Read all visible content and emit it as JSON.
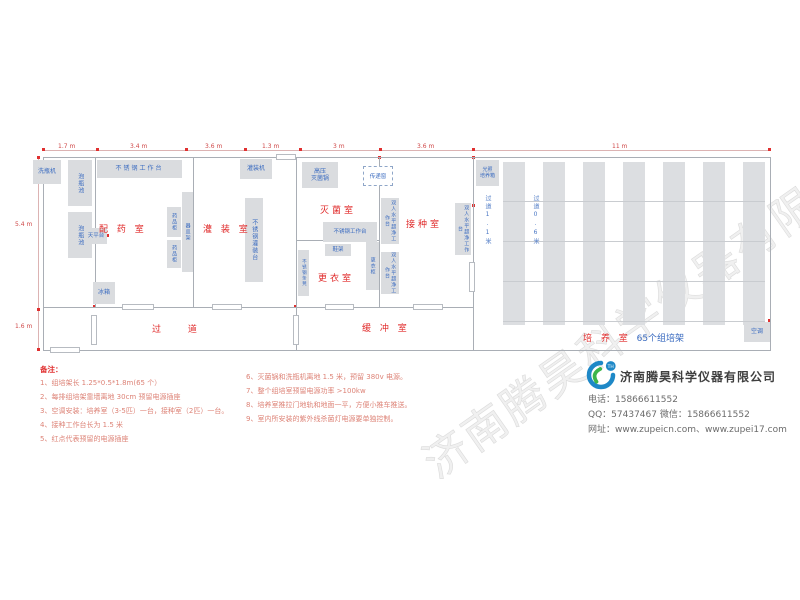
{
  "watermark": "济南腾昊科学仪器有限公司",
  "dimensions": {
    "top": [
      "1.7 m",
      "3.4 m",
      "3.6 m",
      "1.3 m",
      "3 m",
      "3.6 m",
      "11 m"
    ],
    "left": [
      "5.4 m",
      "1.6 m"
    ]
  },
  "rooms": {
    "peiyao": "配 药 室",
    "guanzhuang": "灌 装 室",
    "miejun": "灭菌室",
    "jiezhong": "接种室",
    "gengyi": "更衣室",
    "guodao": "过    道",
    "huanchong": "缓 冲 室",
    "peiyang_red": "培 养 室",
    "peiyang_blue": "65个组培架"
  },
  "equipment": {
    "washer": "洗瓶机",
    "soak_pool": "泡瓶池",
    "ss_workbench": "不锈钢工作台",
    "balance_table": "天平台",
    "medicine_cabinet": "药品柜",
    "vessel_rack": "器皿架",
    "filling_machine": "灌装机",
    "ss_filling_table": "不锈钢灌装台",
    "autoclave_l1": "高压",
    "autoclave_l2": "灭菌锅",
    "pass_window": "传递窗",
    "clean_bench": "双人水平超净工作台",
    "shoe_rack": "鞋架",
    "wardrobe": "更衣柜",
    "ss_bench": "不锈钢条凳",
    "fridge": "冰箱",
    "incubator_l1": "光照",
    "incubator_l2": "培养箱",
    "air_conditioner": "空调",
    "aisle_wide": "过道1.1米",
    "aisle_narrow": "过道0.6米"
  },
  "notes": {
    "title": "备注：",
    "col1": [
      "1、组培架长 1.25*0.5*1.8m(65 个）",
      "2、每排组培架靠墙离地 30cm 预留电源插座",
      "3、空调安装：培养室（3-5匹）一台，接种室（2匹）一台。",
      "4、接种工作台长为 1.5 米",
      "5、红点代表预留的电源插座"
    ],
    "col2": [
      "6、灭菌锅和洗瓶机离地 1.5 米，预留 380v 电源。",
      "7、整个组培室预留电源功率 >100kw",
      "8、培养室推拉门地轨和地面一平，方便小推车推送。",
      "9、室内所安装的紫外线杀菌灯电源要单独控制。"
    ]
  },
  "footer": {
    "company": "济南腾昊科学仪器有限公司",
    "logo_text": "TH",
    "phone_line": "电话：15866611552",
    "qq_line": "QQ：57437467   微信：15866611552",
    "web_line": "网址：www.zupeicn.com、www.zupei17.com"
  }
}
